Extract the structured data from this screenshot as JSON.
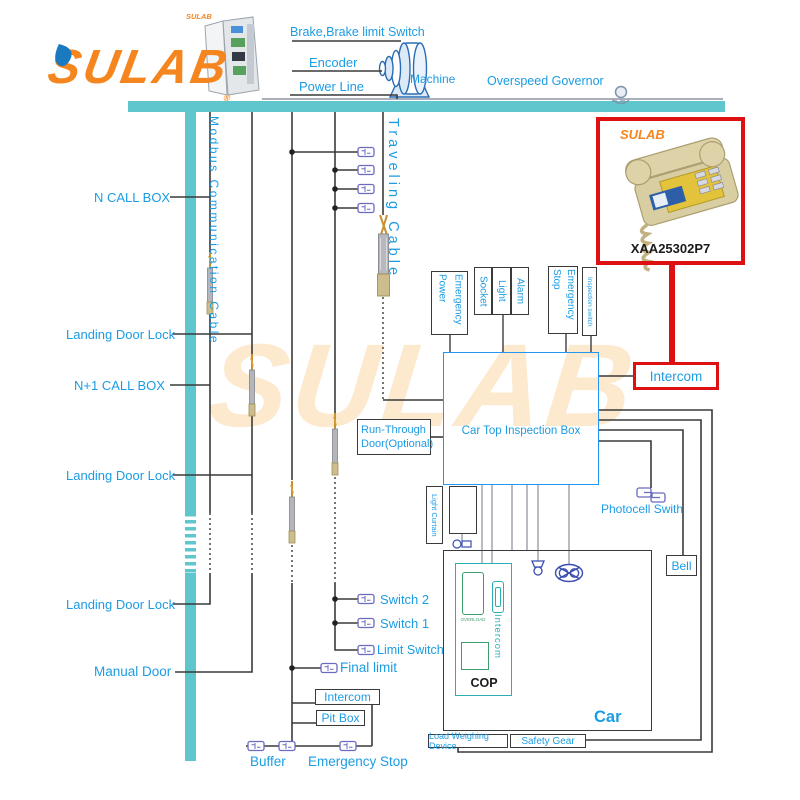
{
  "colors": {
    "teal_bar": "#5FC6CE",
    "label_cyan": "#1C9CE4",
    "wire_black": "#3A3A3A",
    "accent_red": "#DD1111",
    "brand_orange": "#F5861F",
    "switch_purple": "#6A6AC0"
  },
  "logo": {
    "text": "SULAB",
    "registered": "®"
  },
  "watermark": "SULAB",
  "cabinet": {
    "brand": "SULAB"
  },
  "machine_room": {
    "brake": "Brake,Brake limit Switch",
    "encoder": "Encoder",
    "power_line": "Power Line",
    "machine": "Machine",
    "overspeed": "Overspeed Governor"
  },
  "shaft": {
    "modbus": "Modbus Communication Cable",
    "traveling": "Traveling Cable",
    "n_call_box": "N CALL BOX",
    "n1_call_box": "N+1 CALL BOX",
    "landing_door_lock": "Landing Door Lock",
    "manual_door": "Manual Door",
    "switch_2": "Switch 2",
    "switch_1": "Switch 1",
    "limit_switch": "Limit Switch",
    "final_limit": "Final limit",
    "intercom": "Intercom",
    "pit_box": "Pit Box",
    "buffer": "Buffer",
    "emergency_stop": "Emergency Stop"
  },
  "car_top": {
    "title": "Car Top Inspection Box",
    "emergency_power": "Emergency Power",
    "socket": "Socket",
    "light": "Light",
    "alarm": "Alarm",
    "emergency_stop": "Emergency Stop",
    "inspection_switch": "Inspection switch",
    "run_through_line1": "Run-Through",
    "run_through_line2": "Door(Optional)"
  },
  "car": {
    "label": "Car",
    "cop": "COP",
    "overload": "OVERLOAD",
    "intercom": "Intercom",
    "light_curtain": "Light Curtain",
    "photocell": "Photocell Swith",
    "bell": "Bell",
    "load_weighing": "Load Weighing Device",
    "safety_gear": "Safety Gear"
  },
  "product": {
    "brand": "SULAB",
    "model": "XAA25302P7",
    "intercom": "Intercom"
  }
}
